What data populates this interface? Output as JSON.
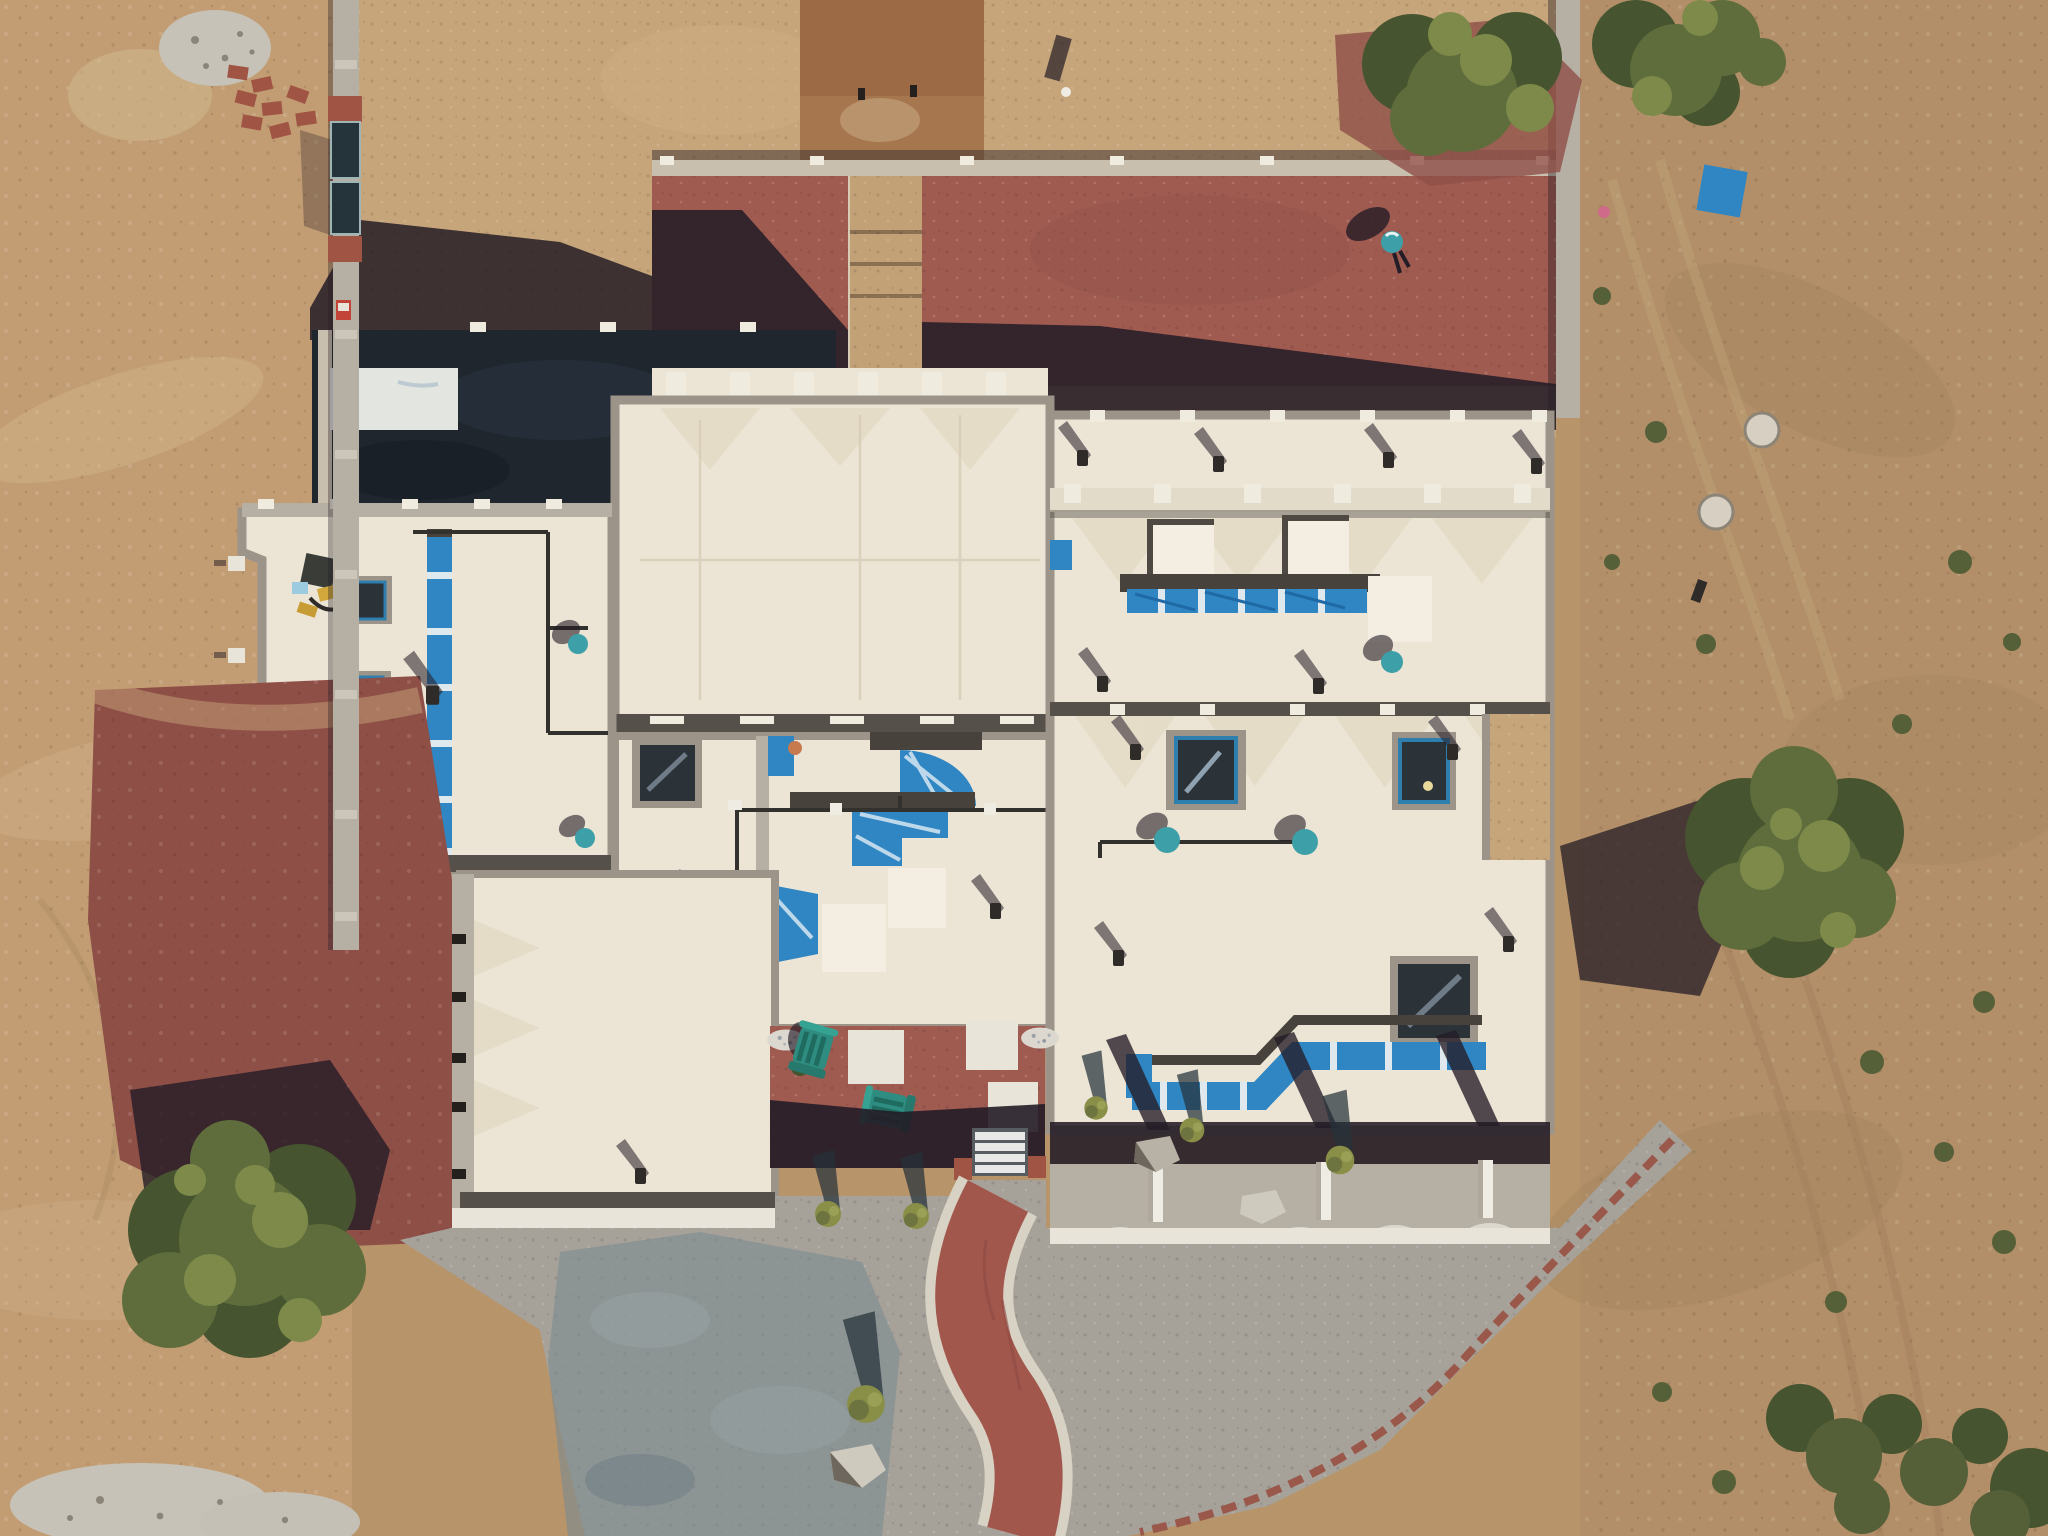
{
  "meta": {
    "type": "aerial-drone-photograph",
    "description": "Top-down aerial view of a large flat-roofed pueblo-style house under construction in a high-desert lot. Cream colored roofs with parapet walls, blue tarp covered skylight channels, red gravel courtyards, a tan gravel yard, gray gravel driveway with a winding red brick path, juniper trees and desert dirt all around.",
    "sun": "low sun from the south-east; shadows fall toward the upper-left"
  },
  "scene": {
    "ground": {
      "left": "graded sandy dirt with equipment tracks",
      "top": "tan decomposed-granite yard inside perimeter wall",
      "right": "native desert with scrub junipers and tire tracks",
      "bottom": "gray base-course driveway pad, partly damp"
    },
    "house": {
      "wings": [
        "upper-left wing with two skylights and blue tarp channel",
        "center block",
        "center-lower wing with blue tarped vault openings",
        "upper-right wing with long blue skylight channel",
        "lower-right wing with L-shaped blue channel and portal posts",
        "lower-left wing"
      ],
      "courtyards": [
        "north shaded gravel courtyard",
        "west red-gravel courtyard",
        "large east red-gravel courtyard",
        "entry courtyard with two rocking chairs and square pavers"
      ]
    },
    "objects": {
      "rocking_chairs": 2,
      "paver_squares": 3,
      "skylights_left_wing": 2,
      "roof_windows_right_wing": 3,
      "entry_steps": 4,
      "gate_panels": 2,
      "brick_pile": 1,
      "gravel_pile": 1,
      "trees_large": 3,
      "small_landscape_trees": 6,
      "boulders": 3,
      "splash_rock_piles": 5,
      "manhole_lids": 2
    },
    "colors": {
      "dirt_left": "#c29d73",
      "dirt_base": "#b7946a",
      "desert": "#b28f68",
      "desert_dark": "#a0805a",
      "gravel_yard": "#c6a57b",
      "pad_brown": "#9c6b46",
      "pad_brown_light": "#ab7a52",
      "steps_tan": "#c2a176",
      "courtyard_red": "#a05b51",
      "courtyard_red_deep": "#8e4f47",
      "shadow_dark": "#241c26",
      "shadow_soft": "#3a2f2f",
      "roof_cream": "#ece5d5",
      "roof_bright": "#f3eee1",
      "roof_dim": "#e2dbc9",
      "roof_cool": "#e3e5e0",
      "parapet_light": "#b6afa4",
      "parapet_gray": "#9c9489",
      "parapet_dark": "#56504a",
      "court_dark_gravel": "#20262e",
      "tarp_blue": "#2f86c2",
      "tarp_blue_deep": "#1f6aa6",
      "frame_blue": "#2f7fae",
      "skylight_dark": "#2b3238",
      "wall_light": "#c9bfae",
      "cap_white": "#f0ebdf",
      "drive_gray": "#a6a29a",
      "drive_wet": "#7c8a92",
      "sidewalk": "#e8e4da",
      "path_brick": "#a2574c",
      "path_border": "#d8d2c4",
      "curb_brick": "#9a584a",
      "brick_red": "#a05544",
      "gate_dark": "#24343a",
      "tree_mid": "#5f6d3c",
      "tree_dark": "#46542f",
      "tree_light": "#7d8a4a",
      "shrub_olive": "#566038",
      "chair_teal": "#2e8d80",
      "vent_teal": "#3da0a8",
      "rock_gray": "#cfcabe",
      "splash_white": "#dcd8cf",
      "gravel_pile": "#c6c2b8",
      "equip_yellow": "#d2a83c",
      "tarp_light": "#9ccade",
      "stain_tan": "#e0d5bd",
      "pipe_dark": "#33312e"
    }
  }
}
